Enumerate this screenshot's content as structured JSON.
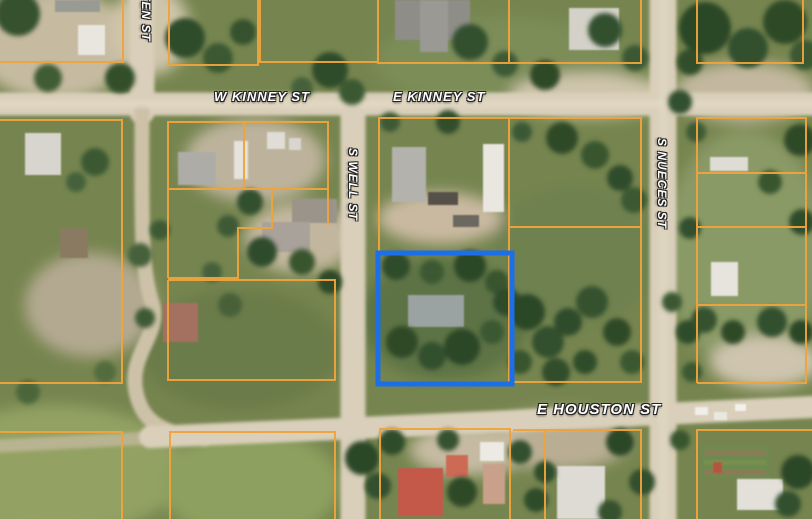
{
  "map": {
    "street_labels": {
      "w_kinney": "W KINNEY ST",
      "e_kinney": "E KINNEY ST",
      "e_houston": "E HOUSTON ST",
      "s_well": "S WELL ST",
      "s_nueces": "S NUECES ST",
      "left_street_partial": "ETEN ST"
    },
    "colors": {
      "parcel_line": "#F0A43C",
      "selected_parcel_outline": "#1C6FE8",
      "road": "#D9CFBA",
      "ground_green": "#7D8A5C"
    }
  }
}
